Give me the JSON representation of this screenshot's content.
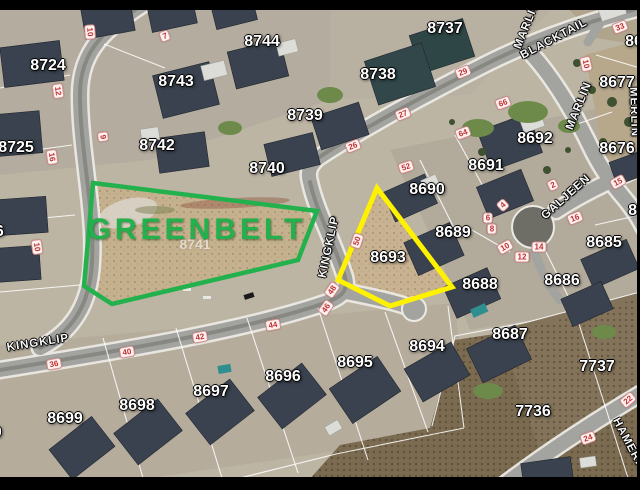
{
  "image": {
    "type": "aerial-parcel-map",
    "greenbelt": {
      "label": "GREENBELT",
      "outline_color": "#22b14c",
      "parcel_number": "8741"
    },
    "highlighted_parcel": {
      "number": "8693",
      "outline_color": "#fff200"
    },
    "colors": {
      "parcel_text": "#ffffff",
      "house_number_text": "#c03030",
      "letterbox": "#000000"
    },
    "streets": [
      {
        "name": "KINGKLIP",
        "x": 38,
        "y": 343,
        "r": -9
      },
      {
        "name": "KINGKLIP",
        "x": 329,
        "y": 247,
        "r": -78
      },
      {
        "name": "BLACKTAIL",
        "x": 554,
        "y": 39,
        "r": -28
      },
      {
        "name": "MARLIN",
        "x": 527,
        "y": 25,
        "r": -68
      },
      {
        "name": "MARLIN",
        "x": 579,
        "y": 106,
        "r": -68
      },
      {
        "name": "GALJEEN",
        "x": 566,
        "y": 197,
        "r": -42
      },
      {
        "name": "MERLIN",
        "x": 634,
        "y": 112,
        "r": 88
      },
      {
        "name": "HAMERKOP",
        "x": 633,
        "y": 452,
        "r": 62
      }
    ],
    "parcel_numbers": [
      {
        "n": "8724",
        "x": 48,
        "y": 66
      },
      {
        "n": "8725",
        "x": 16,
        "y": 148
      },
      {
        "n": "8726",
        "x": -14,
        "y": 232
      },
      {
        "n": "8700",
        "x": -16,
        "y": 433
      },
      {
        "n": "8743",
        "x": 176,
        "y": 82
      },
      {
        "n": "8744",
        "x": 262,
        "y": 42
      },
      {
        "n": "8737",
        "x": 445,
        "y": 29
      },
      {
        "n": "8738",
        "x": 378,
        "y": 75
      },
      {
        "n": "8739",
        "x": 305,
        "y": 116
      },
      {
        "n": "8742",
        "x": 157,
        "y": 146
      },
      {
        "n": "8740",
        "x": 267,
        "y": 169
      },
      {
        "n": "8741",
        "x": 195,
        "y": 244,
        "faint": true
      },
      {
        "n": "8690",
        "x": 427,
        "y": 190
      },
      {
        "n": "8691",
        "x": 486,
        "y": 166
      },
      {
        "n": "8692",
        "x": 535,
        "y": 139
      },
      {
        "n": "8689",
        "x": 453,
        "y": 233
      },
      {
        "n": "8688",
        "x": 480,
        "y": 285
      },
      {
        "n": "8693",
        "x": 388,
        "y": 258
      },
      {
        "n": "8687",
        "x": 510,
        "y": 335
      },
      {
        "n": "8694",
        "x": 427,
        "y": 347
      },
      {
        "n": "8695",
        "x": 355,
        "y": 363
      },
      {
        "n": "8696",
        "x": 283,
        "y": 377
      },
      {
        "n": "8697",
        "x": 211,
        "y": 392
      },
      {
        "n": "8698",
        "x": 137,
        "y": 406
      },
      {
        "n": "8699",
        "x": 65,
        "y": 419
      },
      {
        "n": "8685",
        "x": 604,
        "y": 243
      },
      {
        "n": "8686",
        "x": 562,
        "y": 281
      },
      {
        "n": "8676",
        "x": 617,
        "y": 149
      },
      {
        "n": "8677",
        "x": 617,
        "y": 83
      },
      {
        "n": "86",
        "x": 634,
        "y": 42
      },
      {
        "n": "86",
        "x": 637,
        "y": 211
      },
      {
        "n": "7737",
        "x": 597,
        "y": 367
      },
      {
        "n": "7736",
        "x": 533,
        "y": 412
      }
    ],
    "house_numbers": [
      {
        "n": "7",
        "x": 165,
        "y": 36,
        "r": -20
      },
      {
        "n": "10",
        "x": 90,
        "y": 32,
        "r": 85
      },
      {
        "n": "12",
        "x": 58,
        "y": 91,
        "r": 82
      },
      {
        "n": "9",
        "x": 103,
        "y": 137,
        "r": 82
      },
      {
        "n": "16",
        "x": 52,
        "y": 157,
        "r": 82
      },
      {
        "n": "10",
        "x": 37,
        "y": 247,
        "r": 82
      },
      {
        "n": "26",
        "x": 353,
        "y": 146,
        "r": -22
      },
      {
        "n": "27",
        "x": 403,
        "y": 114,
        "r": -22
      },
      {
        "n": "29",
        "x": 463,
        "y": 72,
        "r": -22
      },
      {
        "n": "33",
        "x": 620,
        "y": 27,
        "r": -22
      },
      {
        "n": "10",
        "x": 586,
        "y": 64,
        "r": 78
      },
      {
        "n": "66",
        "x": 503,
        "y": 103,
        "r": -20
      },
      {
        "n": "64",
        "x": 463,
        "y": 133,
        "r": -20
      },
      {
        "n": "52",
        "x": 406,
        "y": 167,
        "r": -18
      },
      {
        "n": "50",
        "x": 357,
        "y": 241,
        "r": -72
      },
      {
        "n": "48",
        "x": 332,
        "y": 290,
        "r": -55
      },
      {
        "n": "46",
        "x": 326,
        "y": 308,
        "r": -55
      },
      {
        "n": "44",
        "x": 273,
        "y": 325,
        "r": -10
      },
      {
        "n": "42",
        "x": 200,
        "y": 337,
        "r": -10
      },
      {
        "n": "40",
        "x": 127,
        "y": 352,
        "r": -10
      },
      {
        "n": "36",
        "x": 54,
        "y": 364,
        "r": -10
      },
      {
        "n": "2",
        "x": 553,
        "y": 185,
        "r": -25
      },
      {
        "n": "4",
        "x": 503,
        "y": 205,
        "r": -42
      },
      {
        "n": "6",
        "x": 488,
        "y": 218,
        "r": 0
      },
      {
        "n": "8",
        "x": 492,
        "y": 229,
        "r": 0
      },
      {
        "n": "10",
        "x": 505,
        "y": 247,
        "r": -30
      },
      {
        "n": "12",
        "x": 522,
        "y": 257,
        "r": 0
      },
      {
        "n": "14",
        "x": 539,
        "y": 247,
        "r": 0
      },
      {
        "n": "16",
        "x": 575,
        "y": 218,
        "r": -22
      },
      {
        "n": "15",
        "x": 618,
        "y": 182,
        "r": -28
      },
      {
        "n": "22",
        "x": 628,
        "y": 400,
        "r": -40
      },
      {
        "n": "24",
        "x": 588,
        "y": 438,
        "r": -20
      }
    ]
  }
}
